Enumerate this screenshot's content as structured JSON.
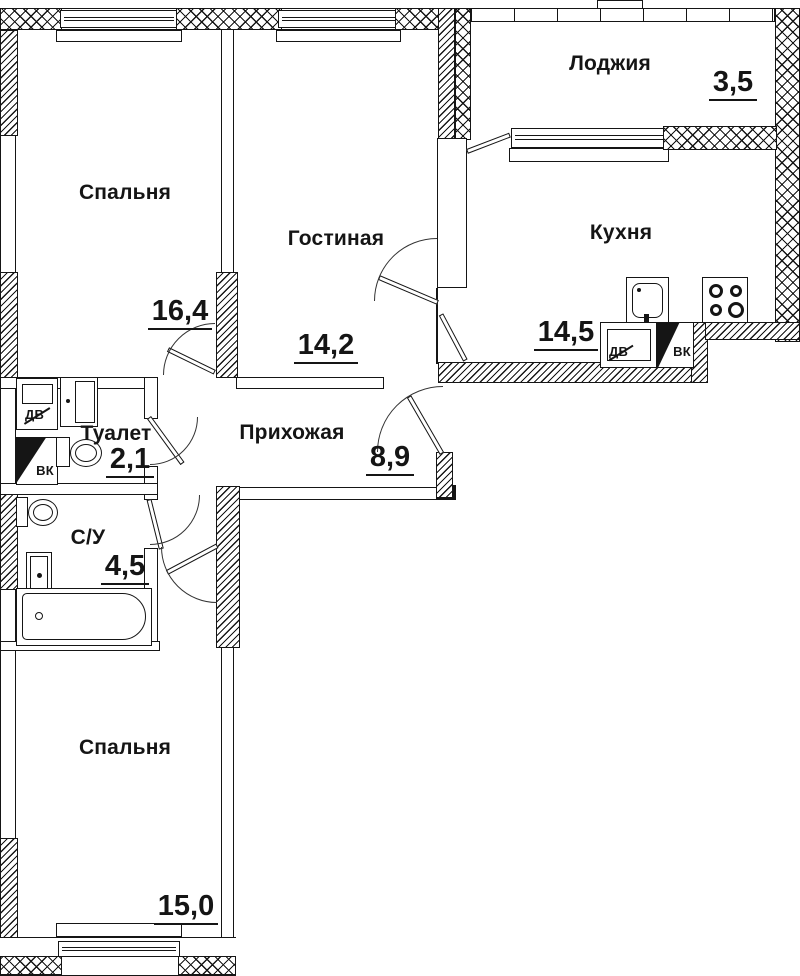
{
  "rooms": {
    "bedroom1": {
      "name": "Спальня",
      "area": "16,4"
    },
    "living": {
      "name": "Гостиная",
      "area": "14,2"
    },
    "loggia": {
      "name": "Лоджия",
      "area": "3,5"
    },
    "kitchen": {
      "name": "Кухня",
      "area": "14,5"
    },
    "toilet": {
      "name": "Туалет",
      "area": "2,1"
    },
    "hallway": {
      "name": "Прихожая",
      "area": "8,9"
    },
    "bathroom": {
      "name": "С/У",
      "area": "4,5"
    },
    "bedroom2": {
      "name": "Спальня",
      "area": "15,0"
    }
  },
  "vents": {
    "toilet_dv": "ДВ",
    "toilet_vk": "ВК",
    "kitchen_dv": "ДВ",
    "kitchen_vk": "ВК"
  },
  "colors": {
    "line": "#151515",
    "bg": "#ffffff"
  }
}
